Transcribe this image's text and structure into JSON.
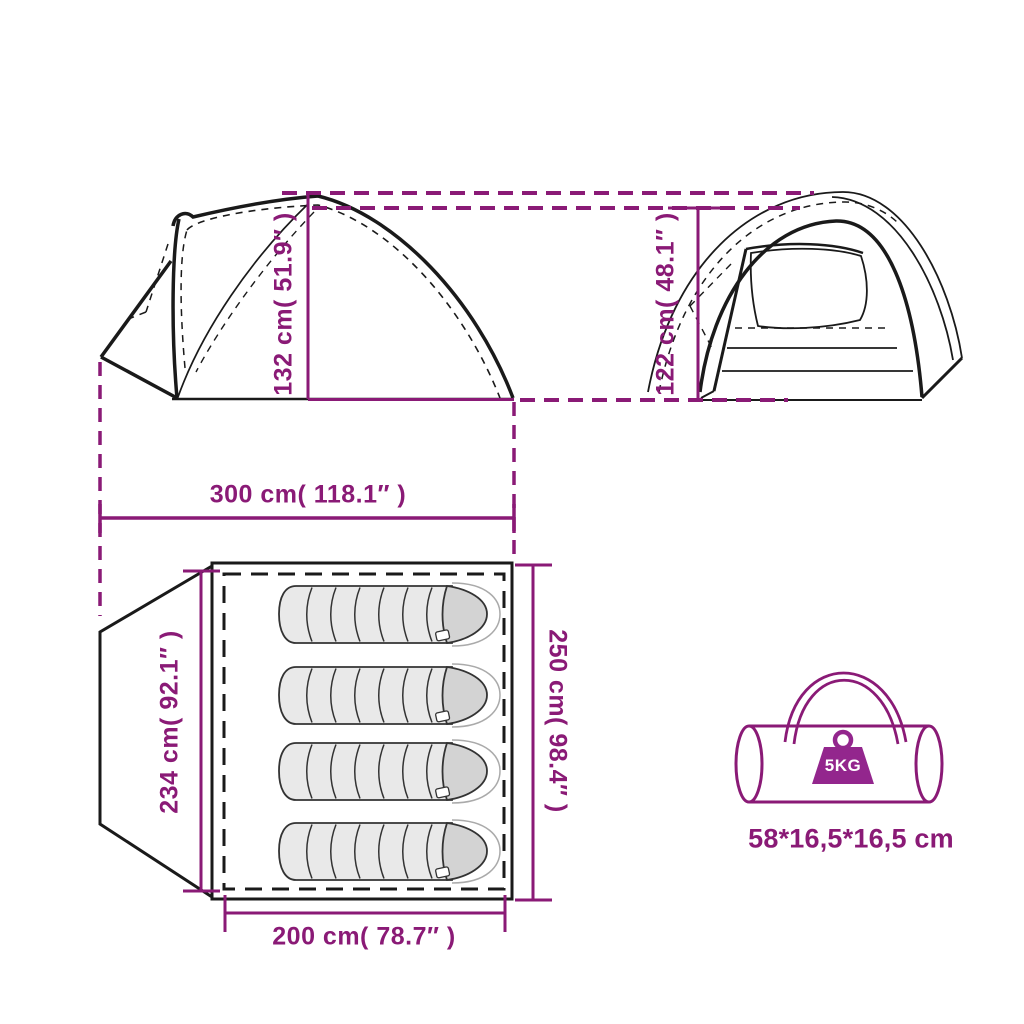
{
  "colors": {
    "accent": "#8a1a76",
    "weight_badge": "#93268d",
    "line_black": "#1a1a1a",
    "sleeping_bag_body": "#e9e9e9",
    "sleeping_bag_hood": "#d3d3d3"
  },
  "views": {
    "side_view": {
      "height_label": "132 cm( 51.9″ )"
    },
    "front_view": {
      "height_label": "122 cm( 48.1″ )"
    },
    "floor_plan": {
      "overall_length_label": "300 cm( 118.1″ )",
      "inner_width_label": "234 cm( 92.1″ )",
      "overall_width_label": "250 cm( 98.4″ )",
      "inner_length_label": "200 cm( 78.7″ )",
      "sleeping_bag_count": 4
    },
    "packed_bag": {
      "weight_label": "5KG",
      "packed_size_label": "58*16,5*16,5 cm"
    }
  }
}
